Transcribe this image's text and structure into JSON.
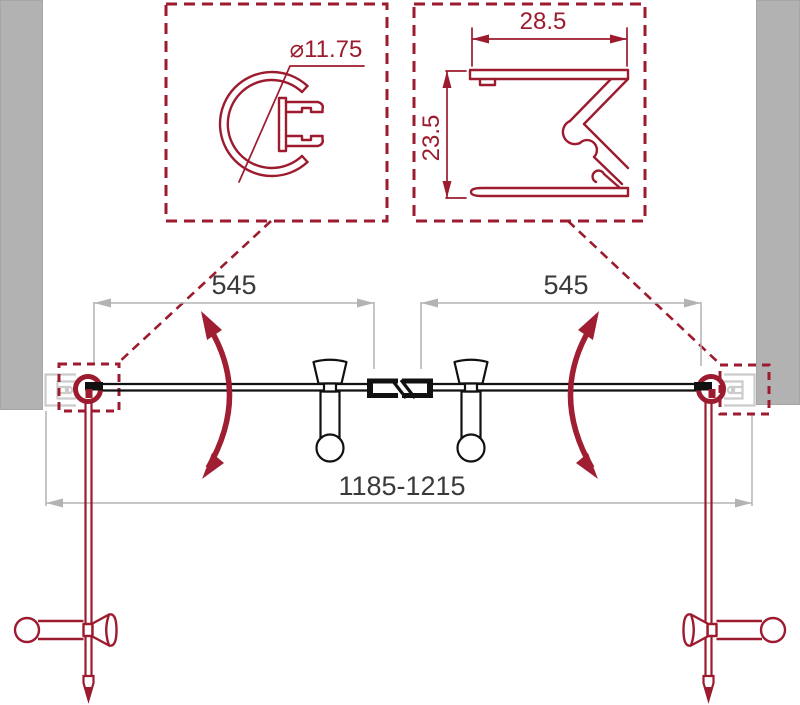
{
  "callouts": {
    "knob_profile": {
      "diameter": "⌀11.75"
    },
    "wall_profile": {
      "width": "28.5",
      "height": "23.5"
    }
  },
  "dimensions": {
    "left_door_width": "545",
    "right_door_width": "545",
    "overall_width": "1185-1215"
  },
  "colors": {
    "line_red": "#9c1b2e",
    "arrow_red": "#a01e32",
    "wall_gray": "#b2b2b2",
    "dim_gray": "#b3b3b3",
    "profile_gray": "#cbcbcb",
    "text_dark": "#3a3a3a",
    "ink_black": "#111111"
  }
}
